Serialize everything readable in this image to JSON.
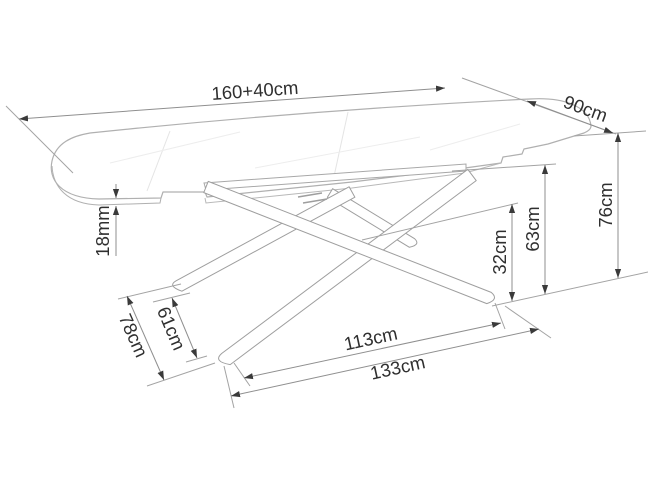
{
  "diagram": {
    "background": "#ffffff",
    "dimensions": {
      "table_length": "160+40cm",
      "table_depth": "90cm",
      "table_height": "76cm",
      "frame_height": "63cm",
      "cross_height": "32cm",
      "top_thickness": "18mm",
      "foot_length": "61cm",
      "base_depth": "78cm",
      "base_span_inner": "113cm",
      "base_span_outer": "133cm"
    },
    "colors": {
      "dimension_line": "#8f8f8f",
      "extension_line": "#a3a3a3",
      "arrowhead": "#3a3a3a",
      "label_text": "#2f2f2f",
      "table_outline": "#b0b0b0",
      "table_fill": "#ffffff",
      "surface_detail": "#e4e4e4"
    }
  }
}
